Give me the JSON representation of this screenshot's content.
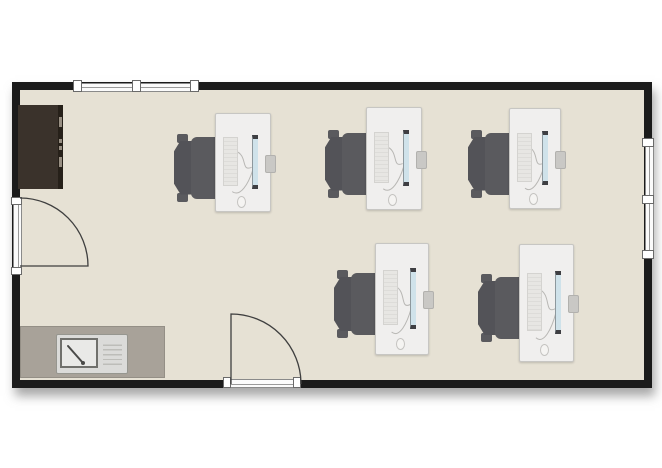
{
  "scene": {
    "type": "floor-plan",
    "description": "office room with five computer workstations, storage cabinet and kitchenette sink counter",
    "canvas": {
      "width": 662,
      "height": 468,
      "background": "#ffffff"
    },
    "room": {
      "x": 12,
      "y": 82,
      "width": 640,
      "height": 306,
      "wall_thickness": 8,
      "wall_color": "#1b1b1b",
      "floor_color": "#e6e1d4"
    },
    "colors": {
      "desk": "#f0efee",
      "chair": "#5a5a5e",
      "cabinet": "#3a322b",
      "counter": "#a8a299",
      "sink": "#dbdbd9",
      "monitor_screen": "#cfe2ea",
      "window_frame": "#ffffff",
      "swing_line": "#3f3f3f"
    },
    "windows": [
      {
        "id": "window-top",
        "wall": "top",
        "x": 77,
        "y": 82,
        "length": 118,
        "panes": 2
      },
      {
        "id": "window-right",
        "wall": "right",
        "x": 644,
        "y": 142,
        "length": 113,
        "panes": 2
      }
    ],
    "doors": [
      {
        "id": "door-left",
        "wall": "left",
        "x": 13,
        "y": 197,
        "length": 78,
        "hinge": "bottom",
        "swing": "in"
      },
      {
        "id": "door-bottom",
        "wall": "bottom",
        "x": 223,
        "y": 379,
        "length": 78,
        "hinge": "left",
        "swing": "in"
      }
    ],
    "cabinet": {
      "x": 18,
      "y": 105,
      "width": 45,
      "height": 84,
      "handles": [
        {
          "top": 12,
          "h": 10
        },
        {
          "top": 34,
          "h": 4
        },
        {
          "top": 41,
          "h": 4
        },
        {
          "top": 52,
          "h": 10
        }
      ]
    },
    "kitchen": {
      "counter": {
        "x": 20,
        "y": 326,
        "width": 145,
        "height": 52
      },
      "sink": {
        "x": 56,
        "y": 334,
        "width": 70,
        "height": 38
      }
    },
    "workstations": [
      {
        "id": "workstation-1",
        "x": 215,
        "y": 113,
        "width": 54,
        "height": 97,
        "chair": "left"
      },
      {
        "id": "workstation-2",
        "x": 366,
        "y": 107,
        "width": 54,
        "height": 101,
        "chair": "left"
      },
      {
        "id": "workstation-3",
        "x": 509,
        "y": 108,
        "width": 50,
        "height": 99,
        "chair": "left"
      },
      {
        "id": "workstation-4",
        "x": 375,
        "y": 243,
        "width": 52,
        "height": 110,
        "chair": "left"
      },
      {
        "id": "workstation-5",
        "x": 519,
        "y": 244,
        "width": 53,
        "height": 116,
        "chair": "left"
      }
    ]
  }
}
